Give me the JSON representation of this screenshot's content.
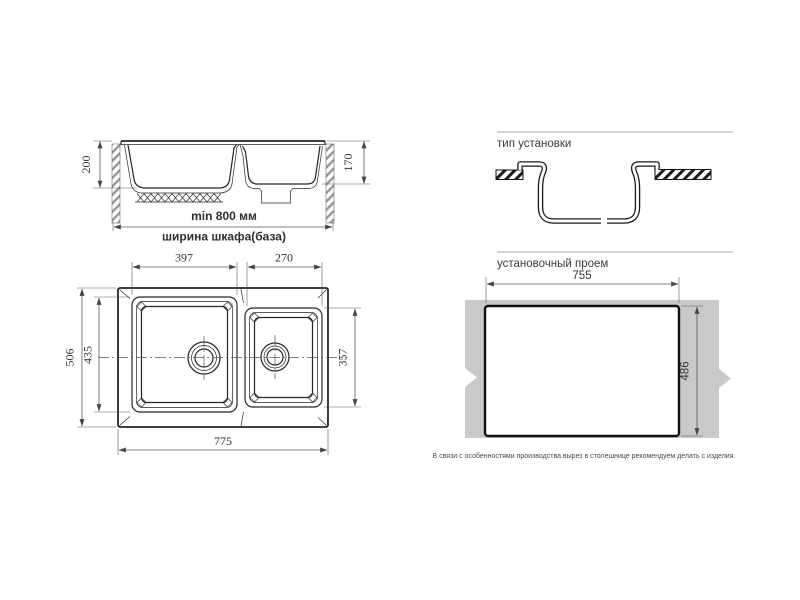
{
  "colors": {
    "line": "#262626",
    "dim_line": "#5a5a5a",
    "text": "#333333",
    "countertop_gray": "#c9c9c9",
    "hatch_gray": "#979797",
    "background": "#ffffff"
  },
  "side_view": {
    "dim_depth_main_bowl": "200",
    "dim_depth_small_bowl": "170",
    "dim_cabinet_min_width": "min 800 мм",
    "dim_cabinet_caption": "ширина шкафа(база)"
  },
  "installation_type": {
    "title": "тип установки"
  },
  "top_view": {
    "dim_main_bowl_width": "397",
    "dim_small_bowl_width": "270",
    "dim_overall_depth": "506",
    "dim_main_bowl_depth": "435",
    "dim_small_bowl_depth": "357",
    "dim_overall_width": "775"
  },
  "cutout_view": {
    "title": "установочный проем",
    "dim_cutout_width": "755",
    "dim_cutout_height": "486",
    "note": "В связи с особенностями производства вырез в столешнице рекомендуем делать с изделия."
  }
}
